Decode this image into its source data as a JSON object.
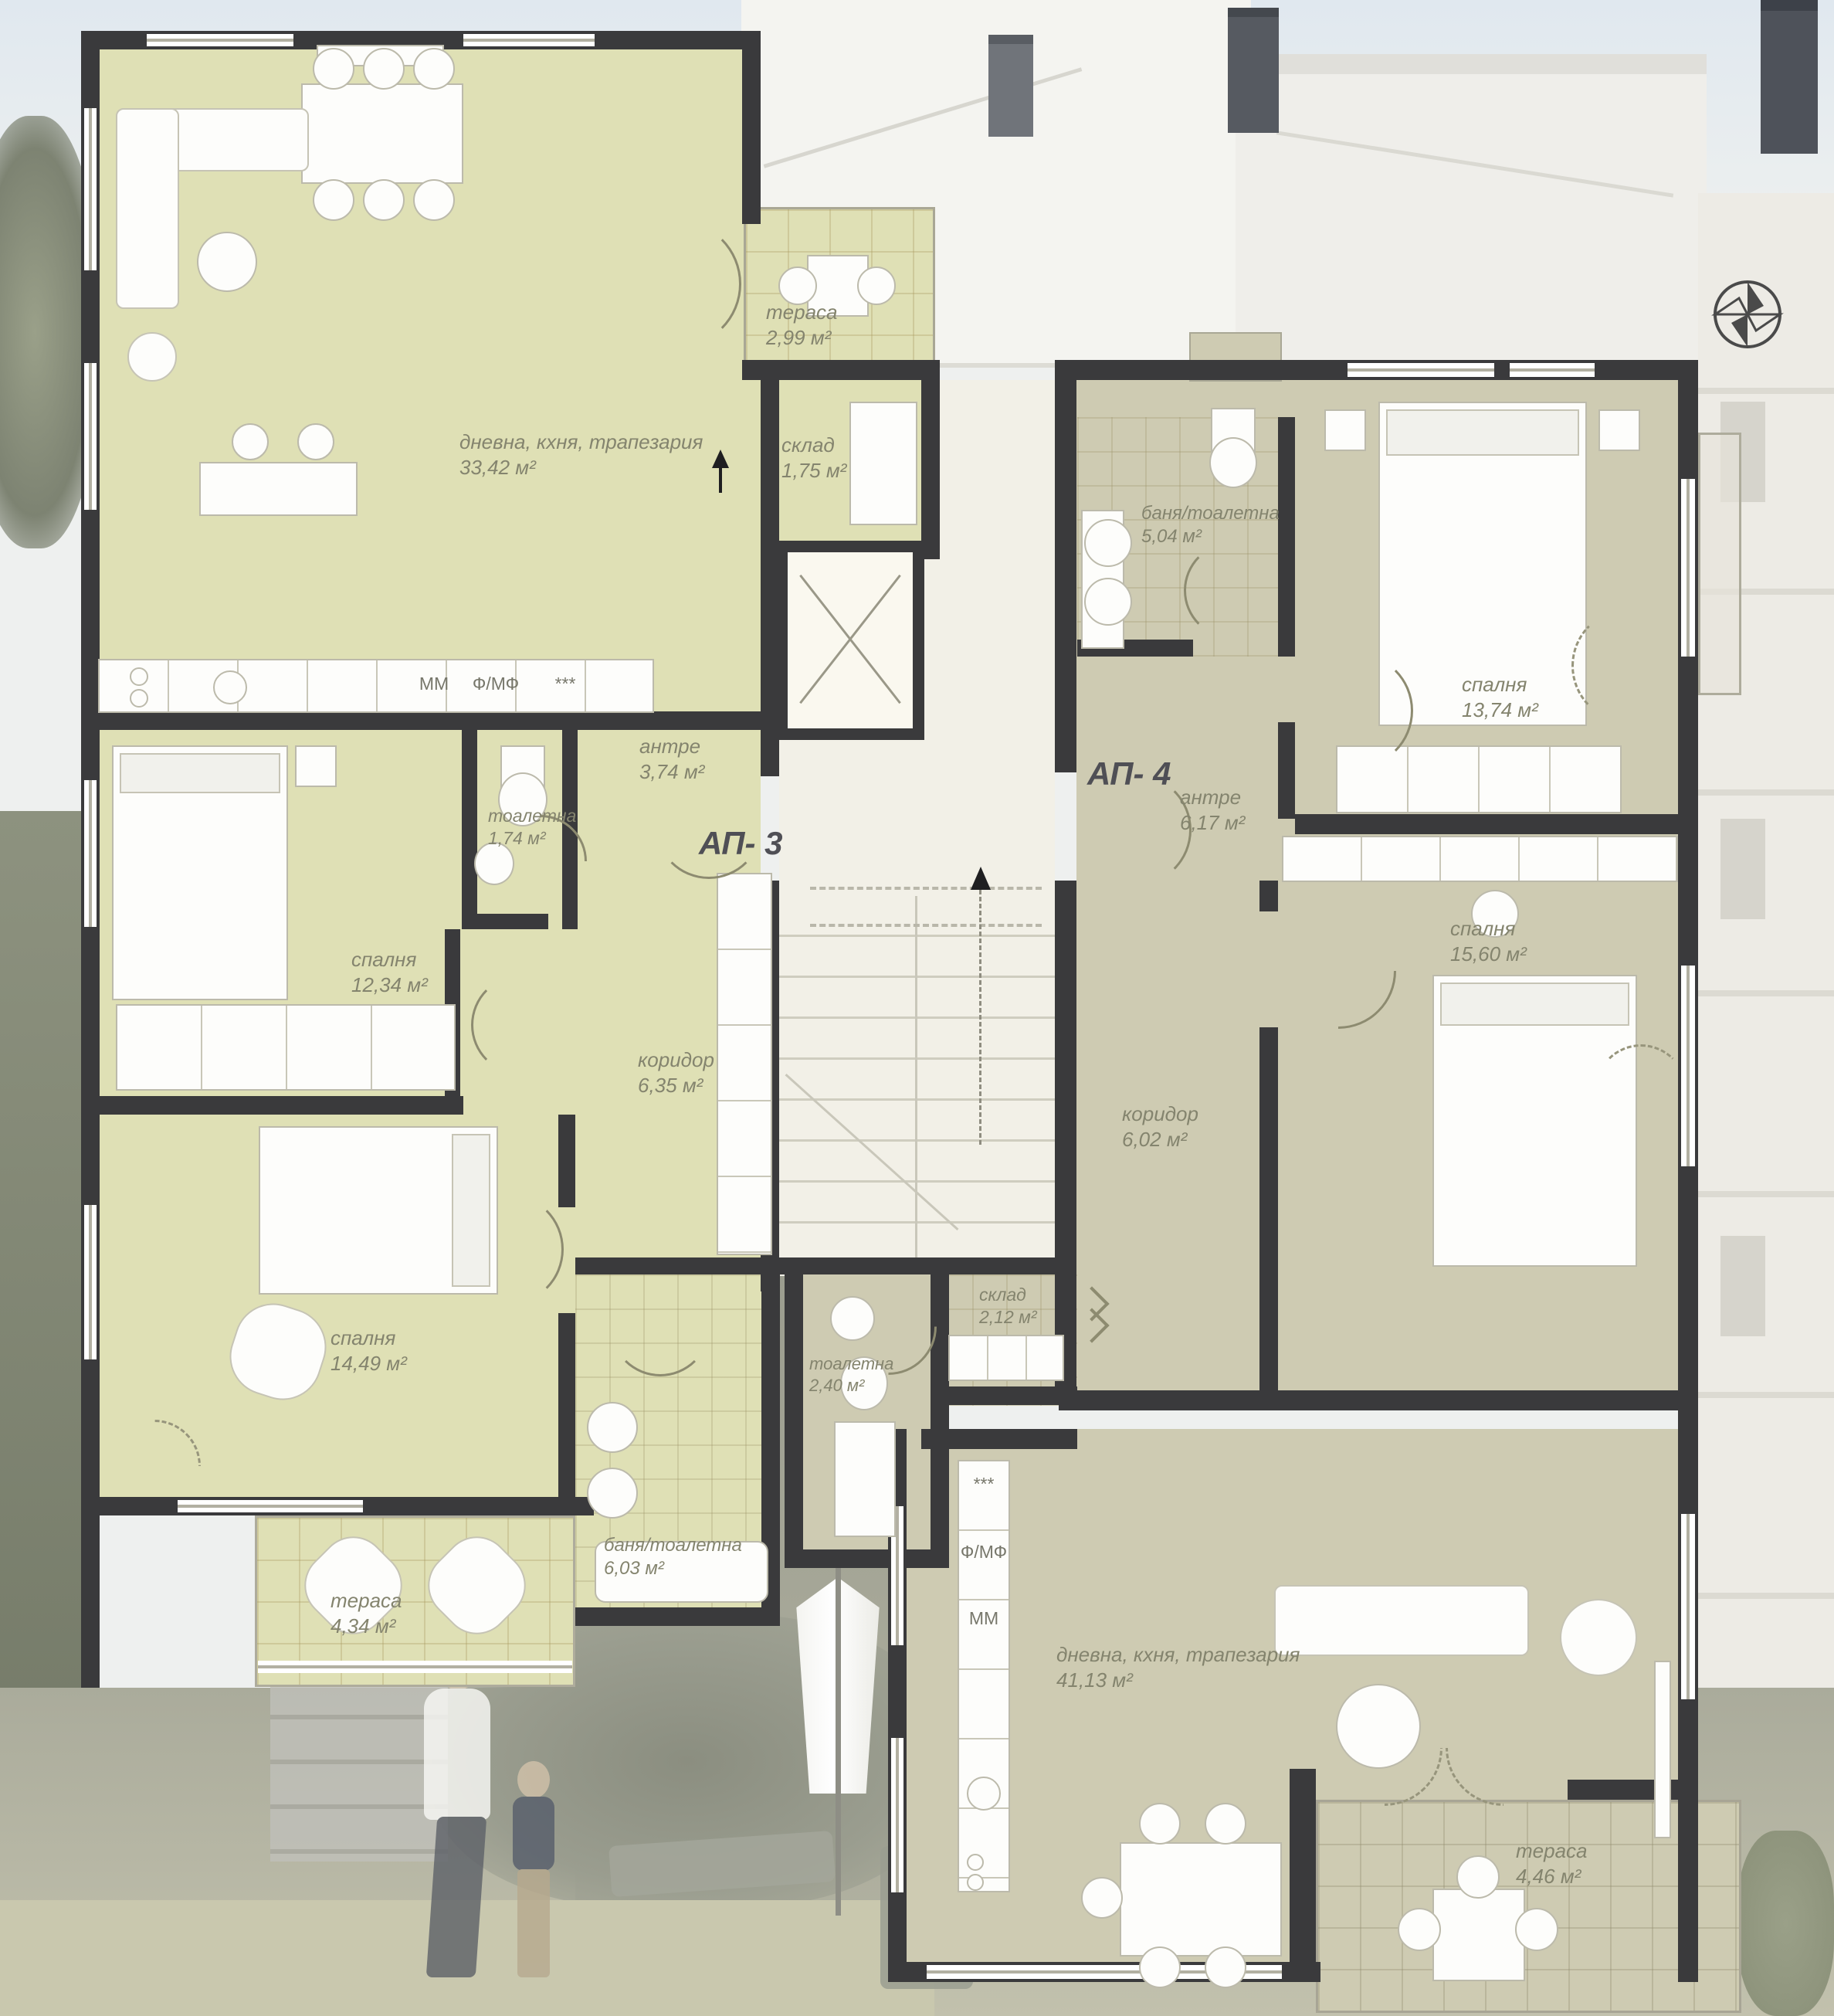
{
  "apartments": {
    "ap3": {
      "label": "АП- 3"
    },
    "ap4": {
      "label": "АП- 4"
    }
  },
  "rooms": {
    "ap3_living": {
      "name": "дневна, кхня, трапезария",
      "area": "33,42 м²"
    },
    "ap3_terrace_top": {
      "name": "тераса",
      "area": "2,99 м²"
    },
    "ap3_storage": {
      "name": "склад",
      "area": "1,75 м²"
    },
    "ap3_entry": {
      "name": "антре",
      "area": "3,74 м²"
    },
    "ap3_toilet": {
      "name": "тоалетна",
      "area": "1,74 м²"
    },
    "ap3_bedroom1": {
      "name": "спалня",
      "area": "12,34 м²"
    },
    "ap3_corridor": {
      "name": "коридор",
      "area": "6,35 м²"
    },
    "ap3_bedroom2": {
      "name": "спалня",
      "area": "14,49 м²"
    },
    "ap3_terrace_bottom": {
      "name": "тераса",
      "area": "4,34 м²"
    },
    "ap3_bath": {
      "name": "баня/тоалетна",
      "area": "6,03 м²"
    },
    "ap4_bath": {
      "name": "баня/тоалетна",
      "area": "5,04 м²"
    },
    "ap4_bedroom1": {
      "name": "спалня",
      "area": "13,74 м²"
    },
    "ap4_entry": {
      "name": "антре",
      "area": "6,17 м²"
    },
    "ap4_bedroom2": {
      "name": "спалня",
      "area": "15,60 м²"
    },
    "ap4_corridor": {
      "name": "коридор",
      "area": "6,02 м²"
    },
    "ap4_toilet": {
      "name": "тоалетна",
      "area": "2,40 м²"
    },
    "ap4_storage": {
      "name": "склад",
      "area": "2,12 м²"
    },
    "ap4_living": {
      "name": "дневна, кхня, трапезария",
      "area": "41,13 м²"
    },
    "ap4_terrace": {
      "name": "тераса",
      "area": "4,46 м²"
    }
  },
  "kitchen_codes": {
    "mm": "ММ",
    "fmf": "Ф/МФ",
    "dots": "***"
  },
  "watermark": {
    "text1": "ard",
    "text2": "R"
  },
  "colors": {
    "ap3_fill": "#dfe0b5",
    "ap4_fill": "#cecbb2",
    "wall": "#3a3a3c",
    "core_fill": "#f2f0e7",
    "label_text": "#84846e"
  }
}
